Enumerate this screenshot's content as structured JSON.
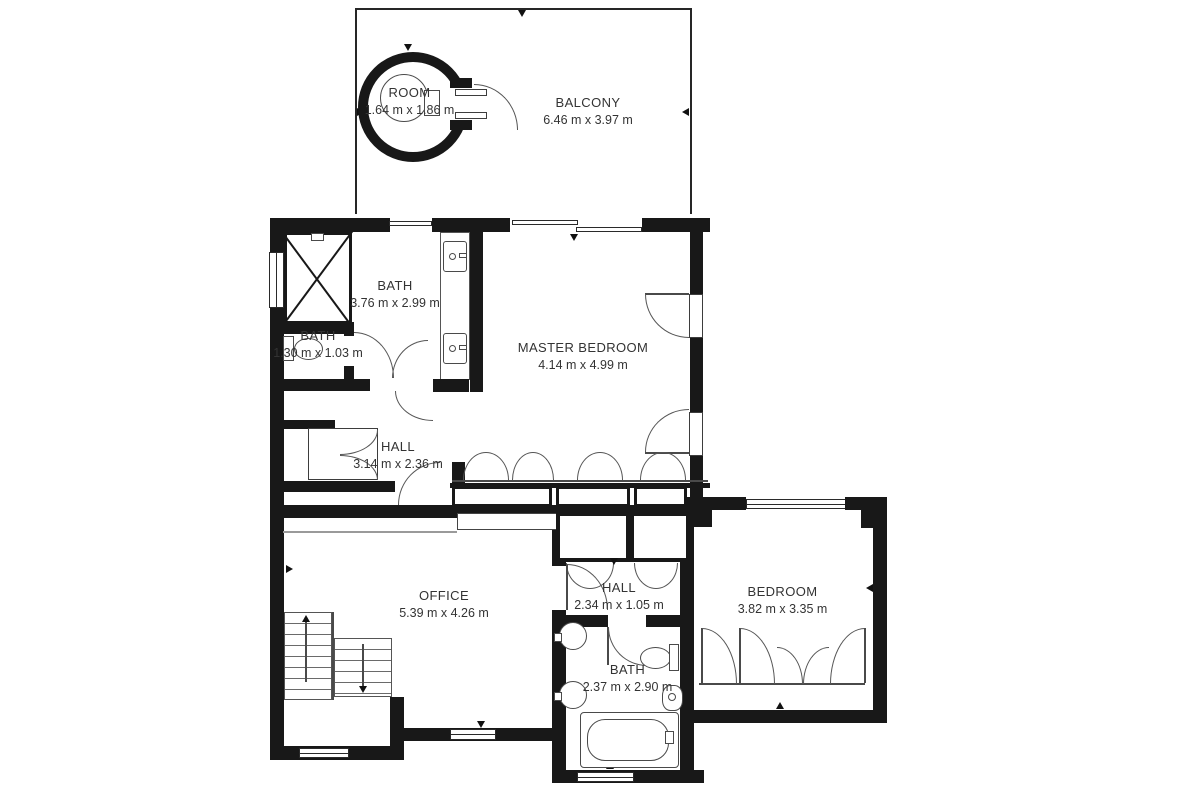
{
  "plan": {
    "title": "Floor plan",
    "rooms": [
      {
        "id": "room-turret",
        "name": "ROOM",
        "dims": "1.64 m x 1.86 m"
      },
      {
        "id": "balcony",
        "name": "BALCONY",
        "dims": "6.46 m x 3.97 m"
      },
      {
        "id": "bath-main",
        "name": "BATH",
        "dims": "3.76 m x 2.99 m"
      },
      {
        "id": "bath-small",
        "name": "BATH",
        "dims": "1.30 m x 1.03 m"
      },
      {
        "id": "master-bedroom",
        "name": "MASTER BEDROOM",
        "dims": "4.14 m x 4.99 m"
      },
      {
        "id": "hall-upper",
        "name": "HALL",
        "dims": "3.14 m x 2.36 m"
      },
      {
        "id": "office",
        "name": "OFFICE",
        "dims": "5.39 m x 4.26 m"
      },
      {
        "id": "hall-lower",
        "name": "HALL",
        "dims": "2.34 m x 1.05 m"
      },
      {
        "id": "bedroom",
        "name": "BEDROOM",
        "dims": "3.82 m x 3.35 m"
      },
      {
        "id": "bath-lower",
        "name": "BATH",
        "dims": "2.37 m x 2.90 m"
      }
    ],
    "colors": {
      "wall": "#181818",
      "thin_line": "#4a4a4a",
      "background": "#ffffff",
      "text": "#333333"
    }
  }
}
